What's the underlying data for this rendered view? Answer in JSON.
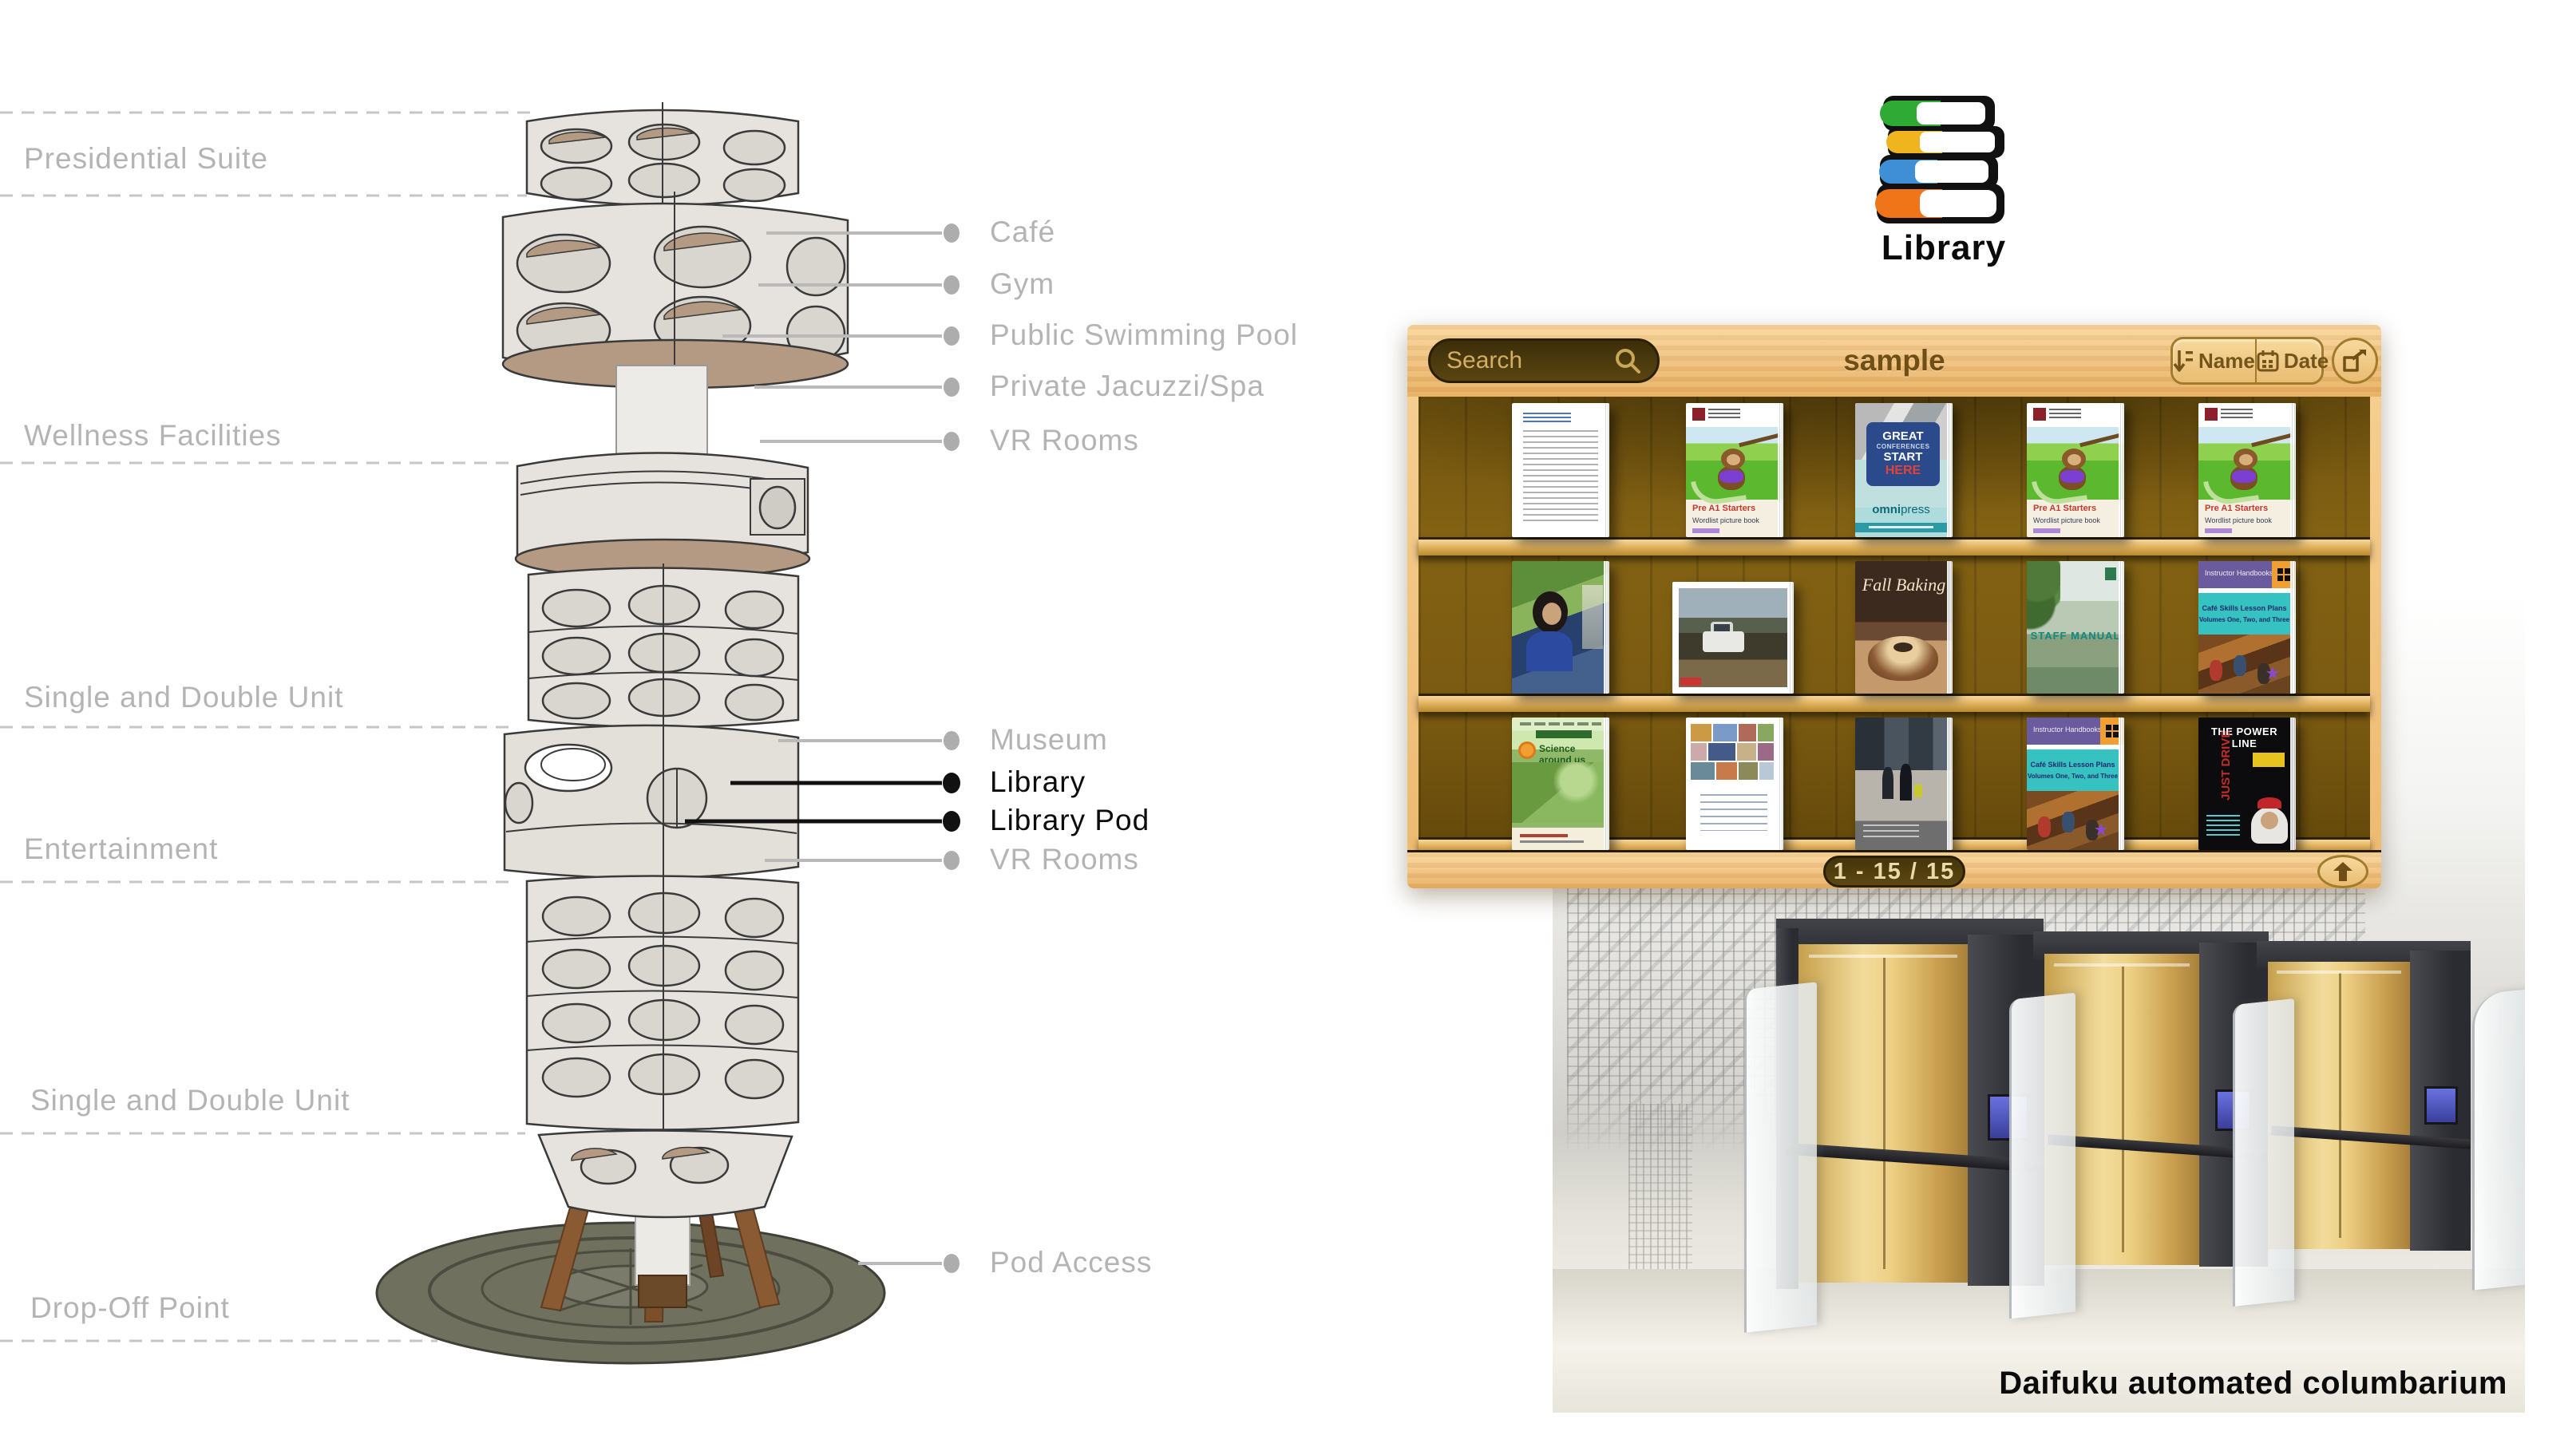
{
  "tower_diagram": {
    "left_labels": [
      {
        "label": "Presidential Suite"
      },
      {
        "label": "Wellness Facilities"
      },
      {
        "label": "Single and Double Unit"
      },
      {
        "label": "Entertainment"
      },
      {
        "label": "Single and Double Unit"
      },
      {
        "label": "Drop-Off Point"
      }
    ],
    "right_labels_top": [
      {
        "label": "Café"
      },
      {
        "label": "Gym"
      },
      {
        "label": "Public Swimming Pool"
      },
      {
        "label": "Private Jacuzzi/Spa"
      },
      {
        "label": "VR Rooms"
      }
    ],
    "right_labels_mid": [
      {
        "label": "Museum",
        "emphasis": false
      },
      {
        "label": "Library",
        "emphasis": true
      },
      {
        "label": "Library Pod",
        "emphasis": true
      },
      {
        "label": "VR Rooms",
        "emphasis": false
      }
    ],
    "right_label_bottom": {
      "label": "Pod Access"
    }
  },
  "library_callout": {
    "icon": "book-stack-icon",
    "label": "Library",
    "book_colors": [
      "#2faa35",
      "#f0b41e",
      "#3f8fd6",
      "#ef7518"
    ]
  },
  "app": {
    "search": {
      "placeholder": "Search",
      "icon": "search-icon"
    },
    "title": "sample",
    "sort_buttons": [
      {
        "icon": "sort-name-icon",
        "label": "Name"
      },
      {
        "icon": "calendar-icon",
        "label": "Date"
      }
    ],
    "share_icon": "share-icon",
    "pagination": "1 - 15 / 15",
    "up_icon": "up-arrow-icon",
    "shelves": [
      {
        "books": [
          {
            "kind": "document",
            "desc": "typed letter page"
          },
          {
            "kind": "starters",
            "title": "Pre A1 Starters",
            "subtitle": "Wordlist picture book"
          },
          {
            "kind": "conference",
            "bubble1": "GREAT",
            "bubble2": "CONFERENCES",
            "bubble3": "START",
            "bubble4": "HERE",
            "brand_bold": "omni",
            "brand_light": "press"
          },
          {
            "kind": "starters",
            "title": "Pre A1 Starters",
            "subtitle": "Wordlist picture book"
          },
          {
            "kind": "starters",
            "title": "Pre A1 Starters",
            "subtitle": "Wordlist picture book"
          }
        ]
      },
      {
        "books": [
          {
            "kind": "photo-people",
            "desc": "photo cover with people"
          },
          {
            "kind": "photo-truck",
            "desc": "landscape photo with truck"
          },
          {
            "kind": "baking",
            "title": "Fall Baking"
          },
          {
            "kind": "staff",
            "title": "STAFF MANUAL"
          },
          {
            "kind": "handbook",
            "header": "Instructor Handbooks",
            "line1": "Café Skills Lesson Plans",
            "line2": "Volumes One, Two, and Three"
          }
        ]
      },
      {
        "books": [
          {
            "kind": "science",
            "title": "Science around us"
          },
          {
            "kind": "collage",
            "desc": "photo collage booklet"
          },
          {
            "kind": "street",
            "desc": "street photo cover"
          },
          {
            "kind": "handbook",
            "header": "Instructor Handbooks",
            "line1": "Café Skills Lesson Plans",
            "line2": "Volumes One, Two, and Three"
          },
          {
            "kind": "powerline",
            "title": "THE POWER LINE"
          }
        ]
      }
    ]
  },
  "columbarium": {
    "caption": "Daifuku automated columbarium"
  },
  "colors": {
    "label_gray": "#b4b4b4",
    "label_black": "#0c0c0c",
    "wood_light": "#f1c383",
    "wood_dark_interior": "#7a5a11",
    "search_pill": "#4a3a10",
    "search_text": "#d2ad62",
    "title_brown": "#6f4f15",
    "booth_gold": "#ecd084",
    "booth_dark": "#36373b",
    "screen_blue": "#5a62d8"
  }
}
